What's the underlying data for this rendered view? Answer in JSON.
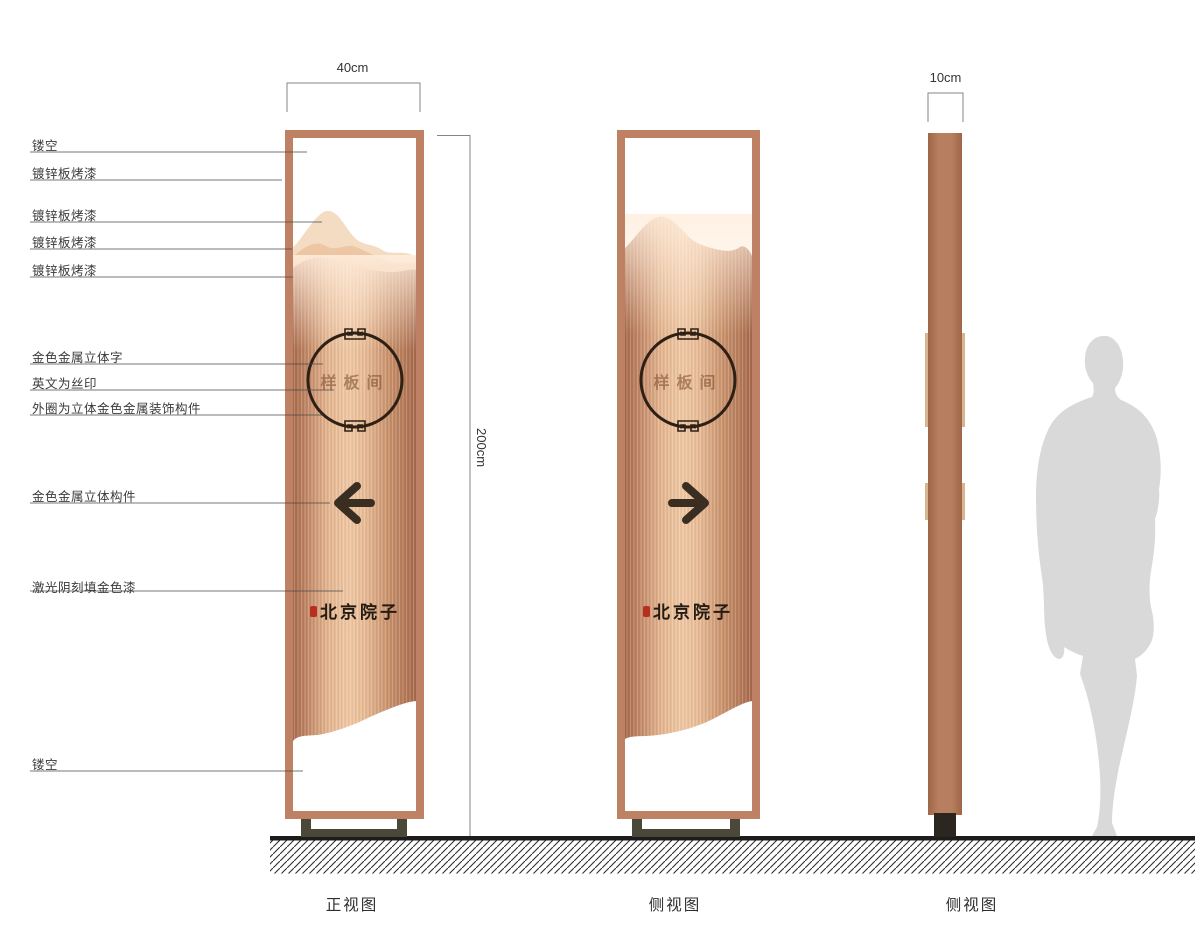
{
  "dimensions": {
    "front_width": "40cm",
    "side_thickness": "10cm",
    "height": "200cm"
  },
  "callouts": [
    "镂空",
    "镀锌板烤漆",
    "镀锌板烤漆",
    "镀锌板烤漆",
    "镀锌板烤漆",
    "金色金属立体字",
    "英文为丝印",
    "外圈为立体金色金属装饰构件",
    "金色金属立体构件",
    "激光阴刻填金色漆",
    "镂空"
  ],
  "captions": {
    "front": "正视图",
    "side1": "侧视图",
    "side2": "侧视图"
  },
  "sign": {
    "room_name": "样板间",
    "brand_name": "北京院子"
  },
  "colors": {
    "frame": "#bf8164",
    "copper_light": "#efc7a3",
    "copper_dark": "#a5684a",
    "mountain_light": "#f4dcc3",
    "mountain_mid": "#edc7a3",
    "base": "#4b4839",
    "profile_base": "#2b2620",
    "seal_red": "#b5301f",
    "silhouette": "#d9d9d9",
    "ink": "#2f2015",
    "ground": "#1c1c1c"
  }
}
